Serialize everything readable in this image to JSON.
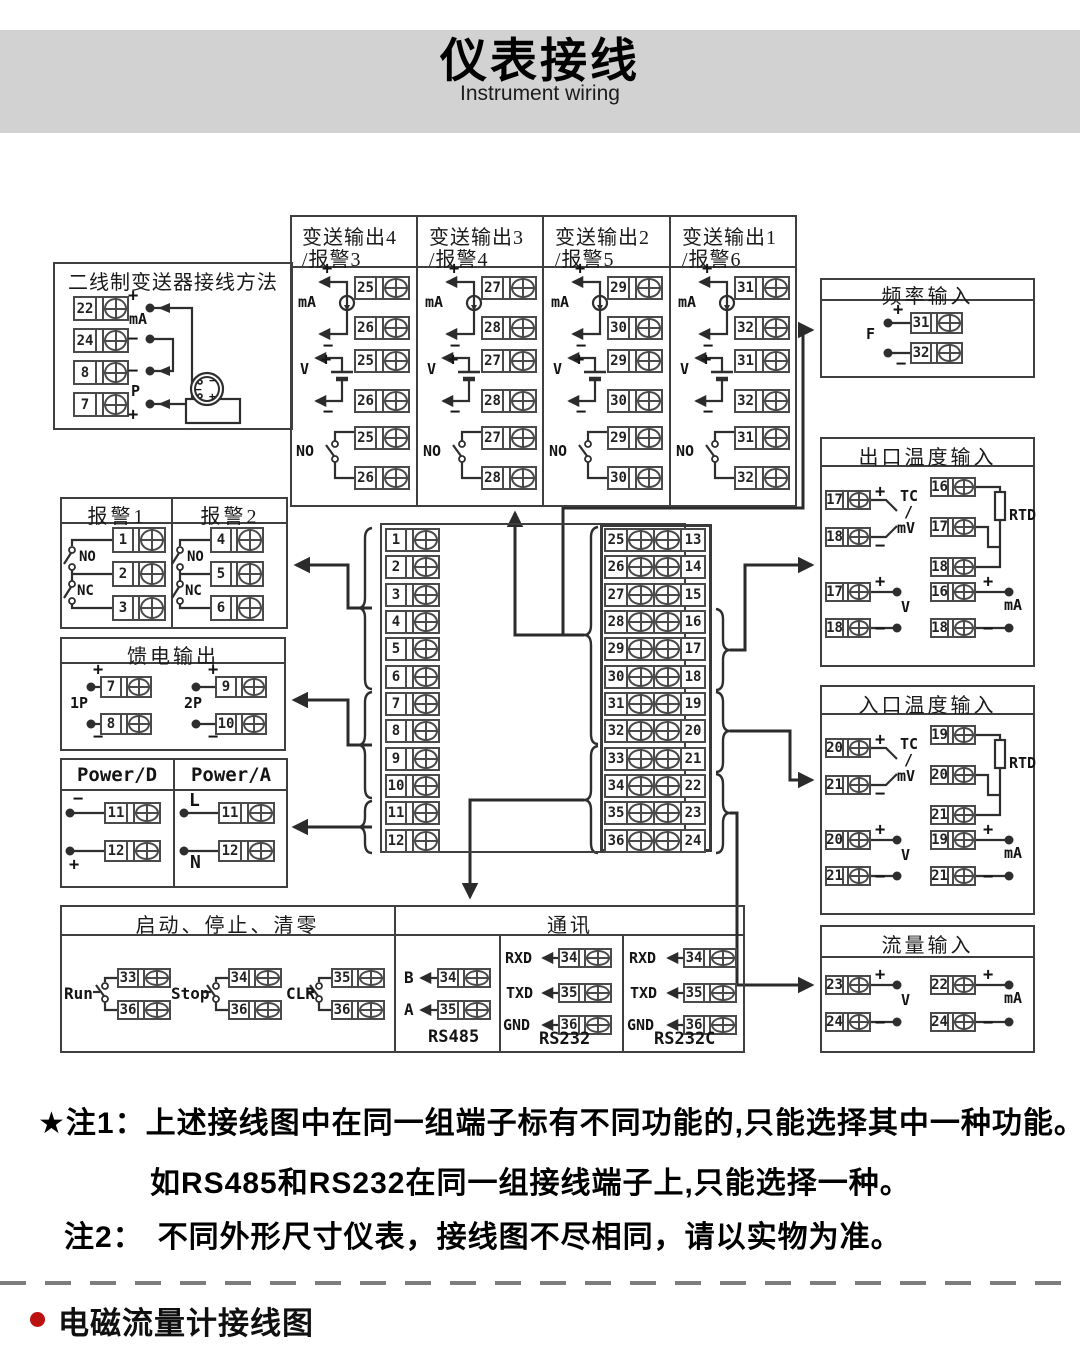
{
  "header": {
    "title": "仪表接线",
    "subtitle": "Instrument wiring"
  },
  "sym": {
    "plus": "+",
    "minus": "−",
    "ma": "mA",
    "v": "V",
    "no": "NO",
    "nc": "NC",
    "f": "F",
    "p": "P",
    "tc": "TC",
    "slash": "/",
    "mv": "mV",
    "rtd": "RTD",
    "l": "L",
    "n": "N"
  },
  "two_wire": {
    "title": "二线制变送器接线方法",
    "terminals": [
      "22",
      "24",
      "8",
      "7"
    ]
  },
  "tx_out": {
    "columns": [
      {
        "title_line1": "变送输出4",
        "title_line2": "/报警3",
        "term_a": "25",
        "term_b": "26"
      },
      {
        "title_line1": "变送输出3",
        "title_line2": "/报警4",
        "term_a": "27",
        "term_b": "28"
      },
      {
        "title_line1": "变送输出2",
        "title_line2": "/报警5",
        "term_a": "29",
        "term_b": "30"
      },
      {
        "title_line1": "变送输出1",
        "title_line2": "/报警6",
        "term_a": "31",
        "term_b": "32"
      }
    ]
  },
  "freq_in": {
    "title": "频率输入",
    "term_a": "31",
    "term_b": "32"
  },
  "alarm": {
    "columns": [
      {
        "title": "报警1",
        "terms": [
          "1",
          "2",
          "3"
        ]
      },
      {
        "title": "报警2",
        "terms": [
          "4",
          "5",
          "6"
        ]
      }
    ]
  },
  "feed_out": {
    "title": "馈电输出",
    "groups": [
      {
        "name": "1P",
        "term_a": "7",
        "term_b": "8"
      },
      {
        "name": "2P",
        "term_a": "9",
        "term_b": "10"
      }
    ]
  },
  "power": {
    "columns": [
      {
        "title": "Power/D",
        "label_a": "−",
        "term_a": "11",
        "label_b": "+",
        "term_b": "12"
      },
      {
        "title": "Power/A",
        "label_a": "L",
        "term_a": "11",
        "label_b": "N",
        "term_b": "12"
      }
    ]
  },
  "center_block": {
    "left": [
      "1",
      "2",
      "3",
      "4",
      "5",
      "6",
      "7",
      "8",
      "9",
      "10",
      "11",
      "12"
    ],
    "mid": [
      "25",
      "26",
      "27",
      "28",
      "29",
      "30",
      "31",
      "32",
      "33",
      "34",
      "35",
      "36"
    ],
    "right": [
      "13",
      "14",
      "15",
      "16",
      "17",
      "18",
      "19",
      "20",
      "21",
      "22",
      "23",
      "24"
    ]
  },
  "out_temp": {
    "title": "出口温度输入",
    "tc": {
      "a": "17",
      "b": "18"
    },
    "rtd": [
      "16",
      "17",
      "18"
    ],
    "volt": {
      "a": "17",
      "b": "18"
    },
    "curr": {
      "a": "16",
      "b": "18"
    }
  },
  "in_temp": {
    "title": "入口温度输入",
    "tc": {
      "a": "20",
      "b": "21"
    },
    "rtd": [
      "19",
      "20",
      "21"
    ],
    "volt": {
      "a": "20",
      "b": "21"
    },
    "curr": {
      "a": "19",
      "b": "21"
    }
  },
  "flow_in": {
    "title": "流量输入",
    "volt": {
      "a": "23",
      "b": "24"
    },
    "curr": {
      "a": "22",
      "b": "24"
    }
  },
  "run_stop": {
    "title": "启动、停止、清零",
    "switches": [
      {
        "name": "Run",
        "term_a": "33",
        "term_b": "36"
      },
      {
        "name": "Stop",
        "term_a": "34",
        "term_b": "36"
      },
      {
        "name": "CLR",
        "term_a": "35",
        "term_b": "36"
      }
    ]
  },
  "comm": {
    "title": "通讯",
    "groups": [
      {
        "name": "RS485",
        "rows": [
          {
            "signal": "B",
            "term": "34"
          },
          {
            "signal": "A",
            "term": "35"
          }
        ]
      },
      {
        "name": "RS232",
        "rows": [
          {
            "signal": "RXD",
            "term": "34"
          },
          {
            "signal": "TXD",
            "term": "35"
          },
          {
            "signal": "GND",
            "term": "36"
          }
        ]
      },
      {
        "name": "RS232C",
        "rows": [
          {
            "signal": "RXD",
            "term": "34"
          },
          {
            "signal": "TXD",
            "term": "35"
          },
          {
            "signal": "GND",
            "term": "36"
          }
        ]
      }
    ]
  },
  "notes": {
    "note1_label": "★注1：",
    "note1_text": "上述接线图中在同一组端子标有不同功能的,只能选择其中一种功能。",
    "note1_text2": "如RS485和RS232在同一组接线端子上,只能选择一种。",
    "note2_label": "注2：",
    "note2_text": "不同外形尺寸仪表，接线图不尽相同，请以实物为准。"
  },
  "footer": {
    "section_title": "电磁流量计接线图"
  },
  "colors": {
    "banner": "#d2d2d2",
    "line": "#2e2e2e",
    "border": "#3f3f3f",
    "accent_red": "#bb1111"
  }
}
